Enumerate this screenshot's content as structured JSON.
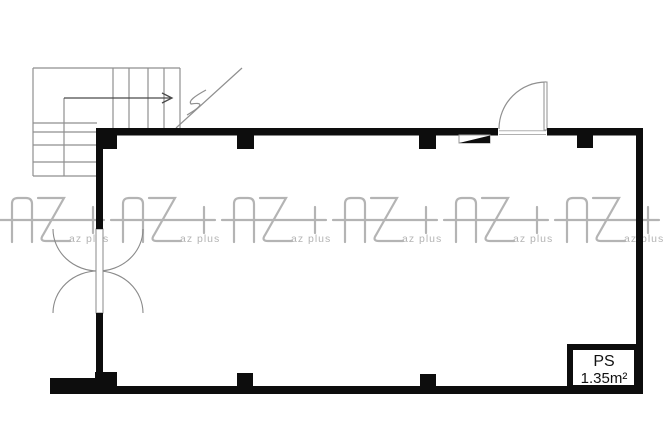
{
  "title": "vacant-unit-floor-plan",
  "colors": {
    "background": "#ffffff",
    "wall": "#0d0d0d",
    "stair_line": "#8f8f8f",
    "arrow": "#4a4a4a",
    "threshold_line": "#b0b0b0",
    "watermark": "#b4b4b4",
    "text": "#111111"
  },
  "ps_box": {
    "label": "PS",
    "area": "1.35m²"
  },
  "watermark": {
    "logo_text": "AZ+",
    "small_text": "az plus",
    "count": 6,
    "positions_x": [
      12,
      123,
      234,
      345,
      456,
      567
    ],
    "y": 198
  }
}
